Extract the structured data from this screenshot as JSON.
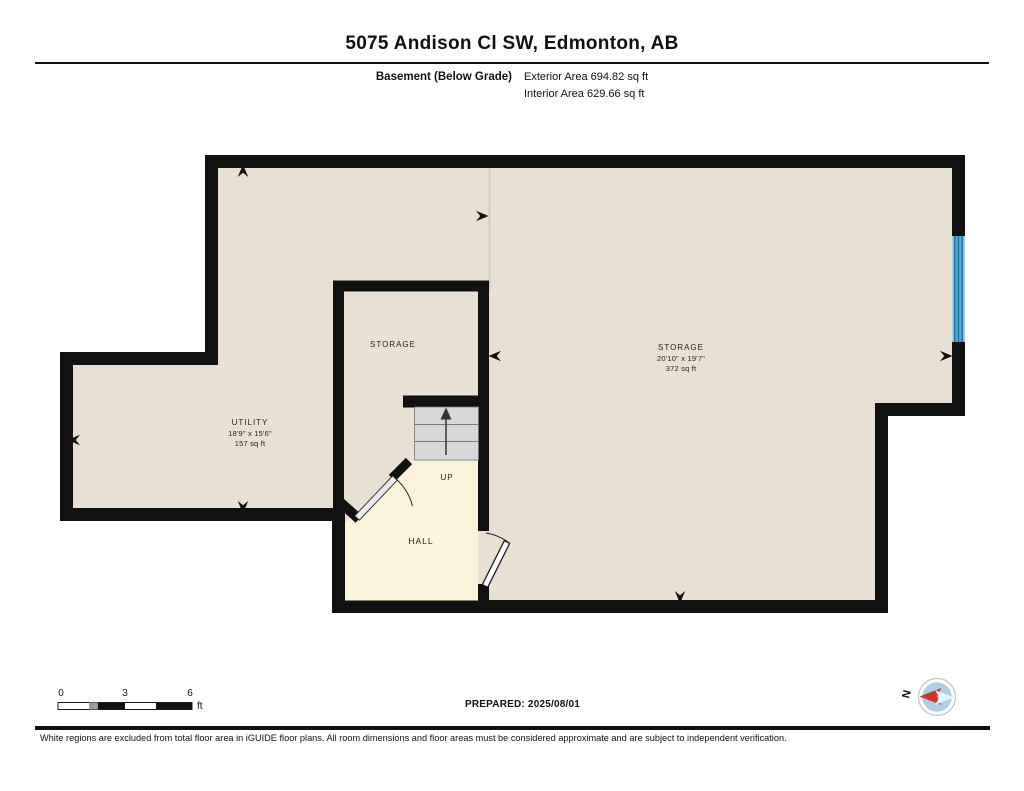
{
  "header": {
    "title": "5075 Andison Cl SW, Edmonton, AB",
    "floor_label": "Basement (Below Grade)",
    "exterior_area": "Exterior Area 694.82 sq ft",
    "interior_area": "Interior Area 629.66 sq ft"
  },
  "rooms": {
    "storage_small": {
      "label": "STORAGE"
    },
    "storage_large": {
      "label": "STORAGE",
      "dims": "20'10\" x 19'7\"",
      "area": "372 sq ft"
    },
    "utility": {
      "label": "UTILITY",
      "dims": "18'9\" x 15'6\"",
      "area": "157 sq ft"
    },
    "hall": {
      "label": "HALL"
    },
    "stairs": {
      "label": "UP"
    }
  },
  "scale_bar": {
    "ticks": [
      "0",
      "3",
      "6"
    ],
    "unit": "ft"
  },
  "footer": {
    "prepared": "PREPARED: 2025/08/01",
    "compass_n": "N",
    "disclaimer": "White regions are excluded from total floor area in iGUIDE floor plans. All room dimensions and floor areas must be considered approximate and are subject to independent verification."
  },
  "colors": {
    "wall": "#111111",
    "floor": "#e8e1d3",
    "hall_floor": "#fbf4da",
    "stairs": "#d8d8d8",
    "window_blue": "#54abd6",
    "compass_red": "#d23324"
  }
}
